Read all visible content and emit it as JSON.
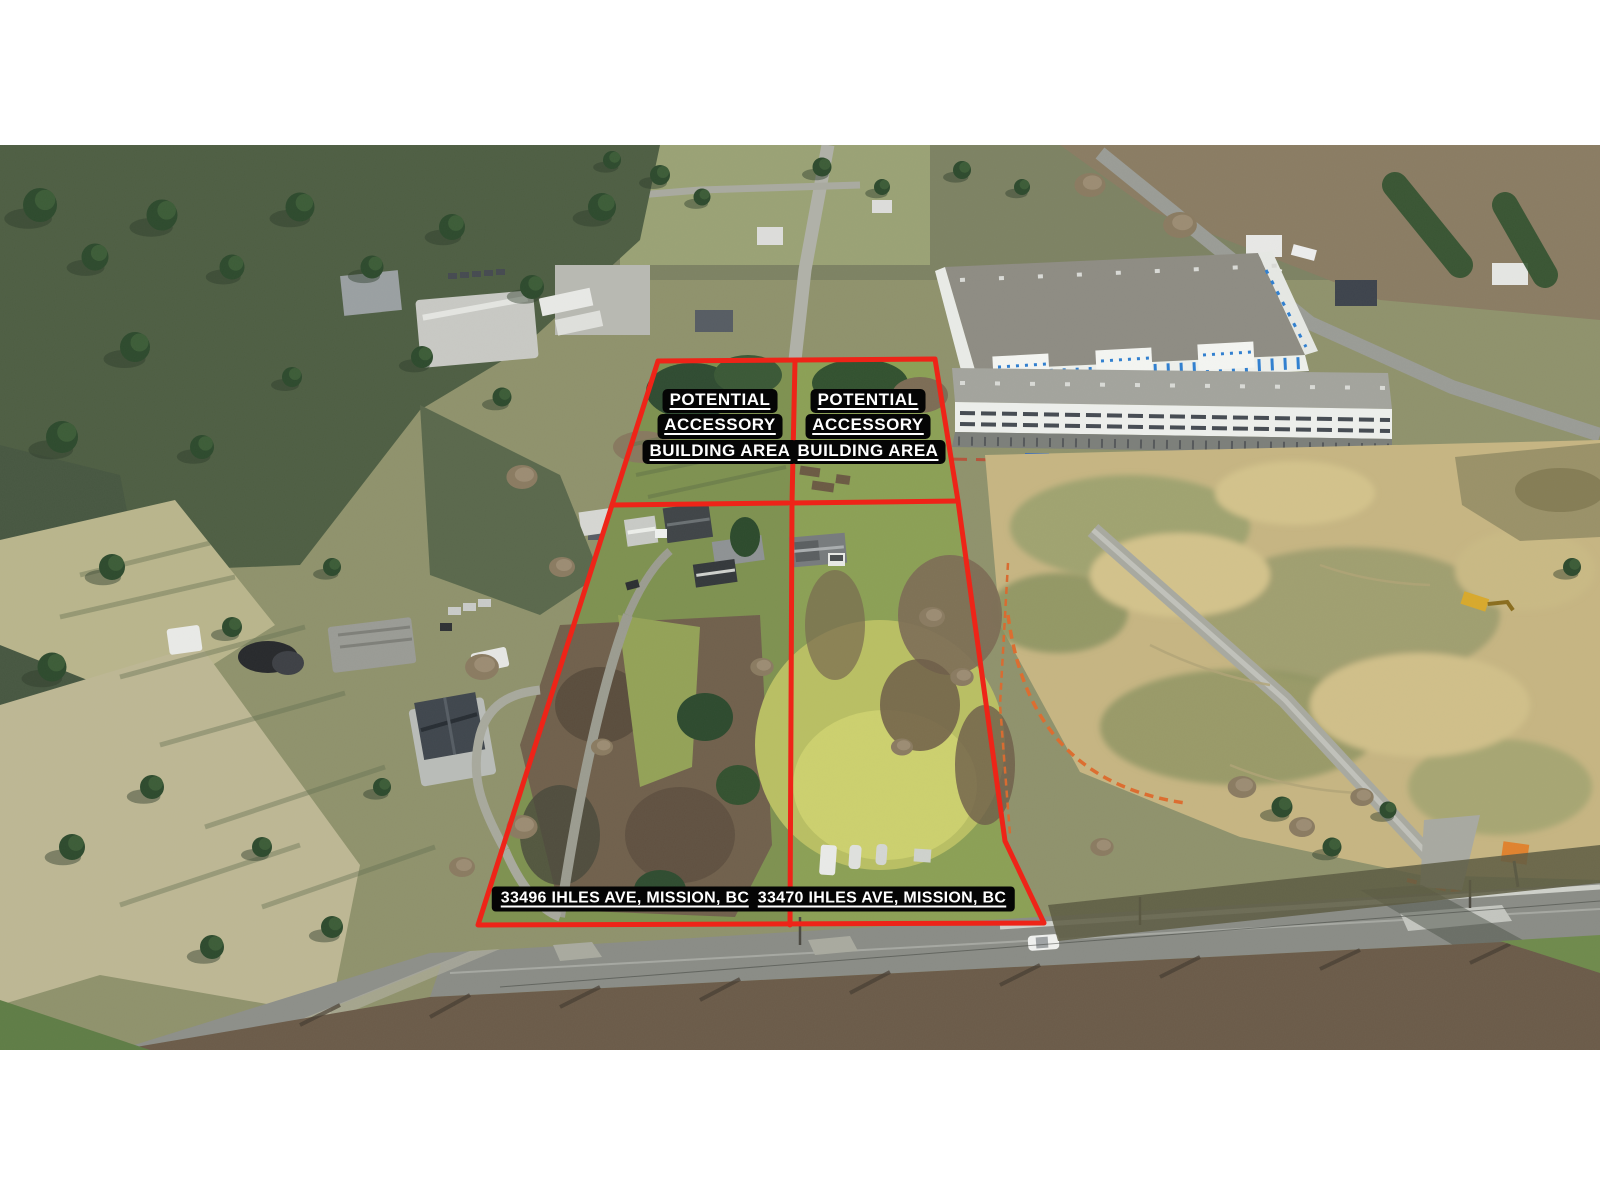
{
  "canvas": {
    "width": 1600,
    "height": 1200,
    "background": "#ffffff"
  },
  "photo_area": {
    "top": 145,
    "height": 905
  },
  "labels": {
    "accessory_area_lines": [
      "POTENTIAL",
      "ACCESSORY",
      "BUILDING AREA"
    ],
    "address_left": "33496 IHLES AVE, MISSION, BC",
    "address_right": "33470 IHLES AVE, MISSION, BC",
    "text_color": "#ffffff",
    "chip_background": "#050505"
  },
  "outline": {
    "color": "#ee2418",
    "stroke_width": 5,
    "outer": "658,216 935,214 958,356 1005,696 1044,778 478,780 612,360",
    "divider_center": "795,216 792,358 790,780",
    "divider_left": "612,360 788,358",
    "divider_right": "792,358 958,356"
  },
  "scene_colors": {
    "forest_green": "#4e5e43",
    "lawn_green": "#7e9150",
    "bright_lawn": "#c2c566",
    "dry_field": "#bdb794",
    "dirt_site": "#c6b582",
    "asphalt": "#8a8c86",
    "industrial_blue": "#2f7fd0",
    "construction_orange": "#dd6c2e"
  }
}
